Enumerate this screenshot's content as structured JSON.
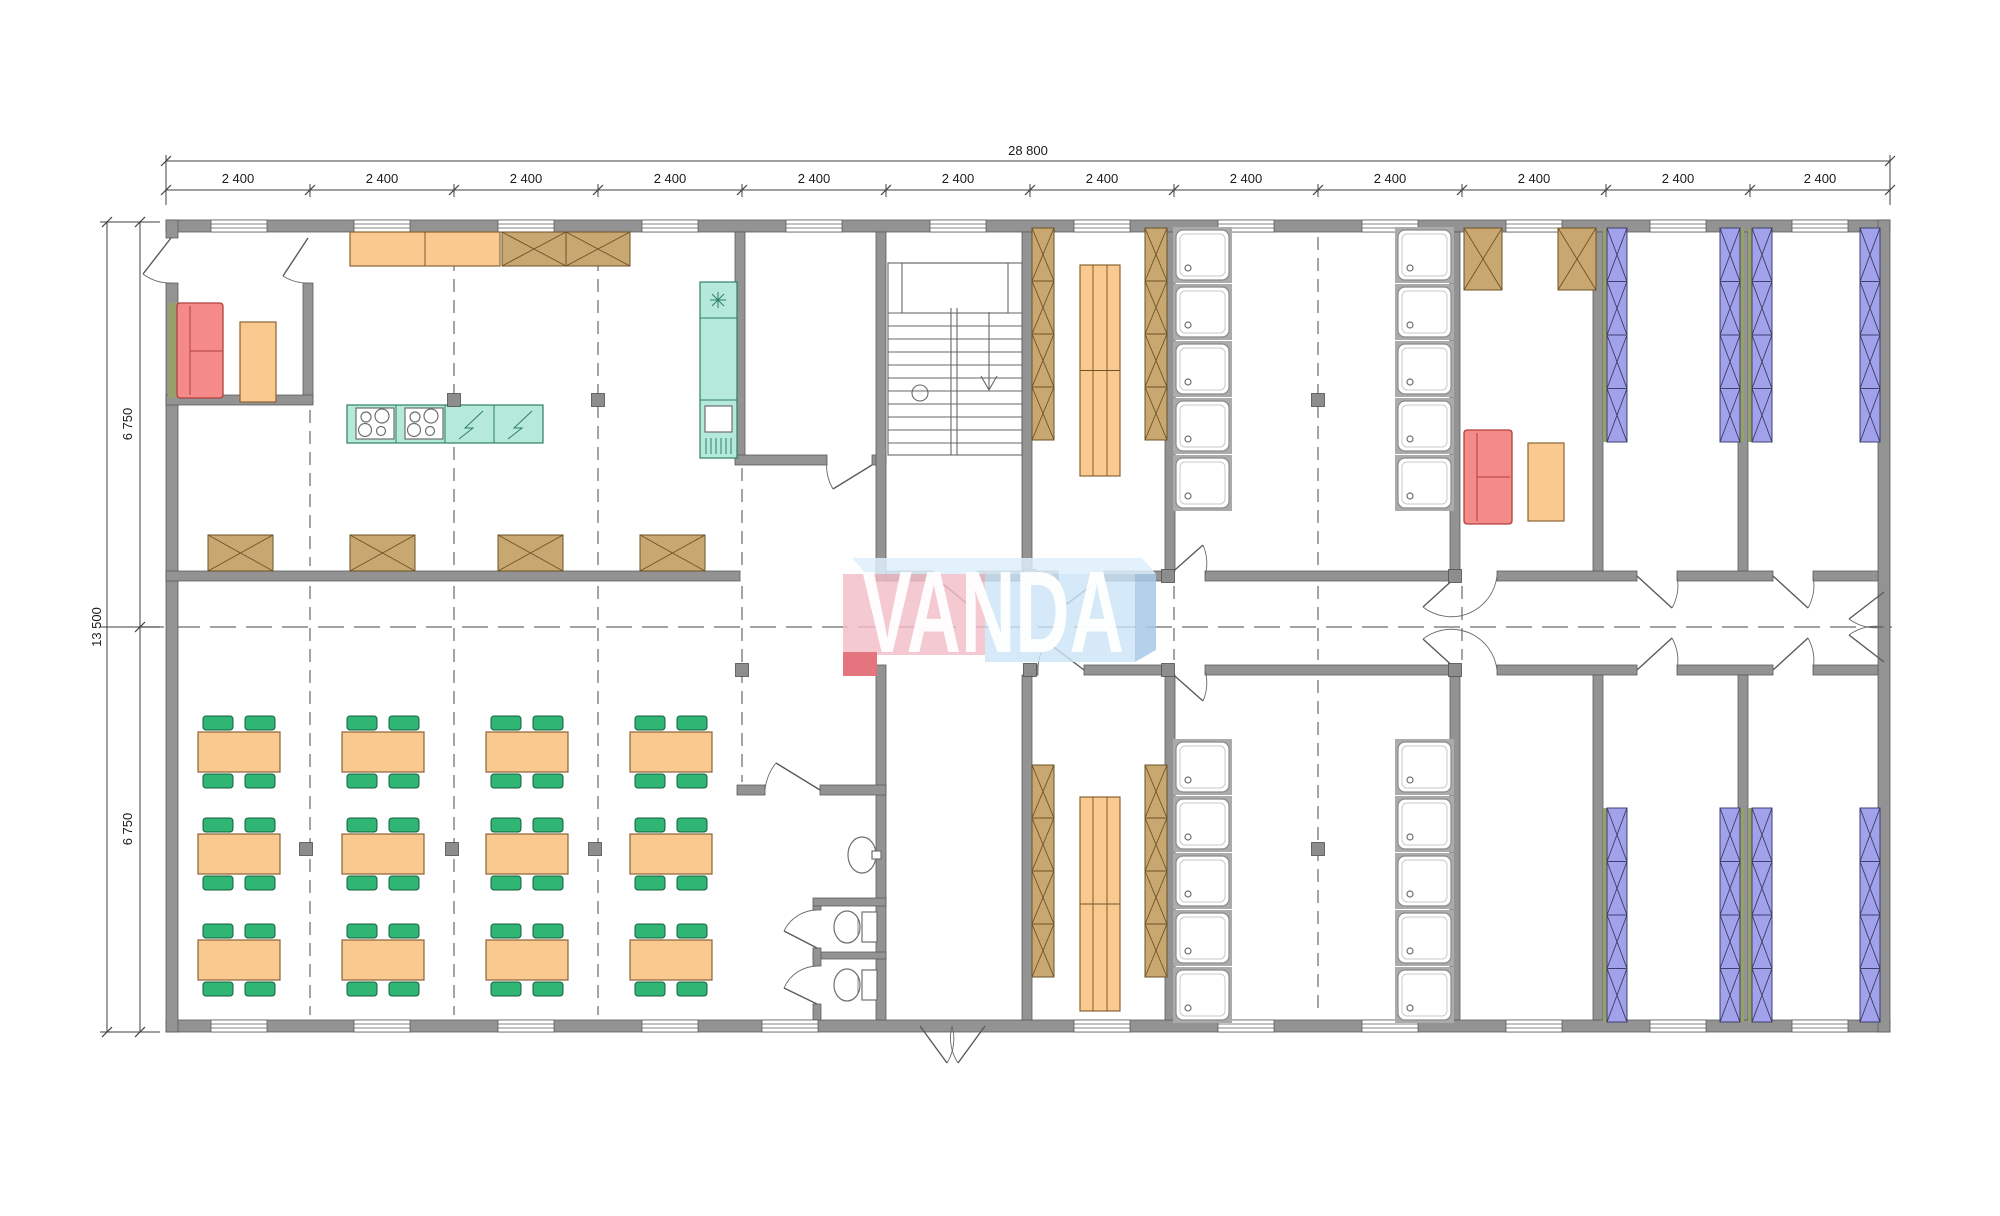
{
  "title": "VANDA modular building floor plan",
  "watermark": {
    "text": "VANDA",
    "pink": "#f3bdc8",
    "blue": "#cbe4f6"
  },
  "dimensions": {
    "top_total": "28 800",
    "top_segments": [
      "2 400",
      "2 400",
      "2 400",
      "2 400",
      "2 400",
      "2 400",
      "2 400",
      "2 400",
      "2 400",
      "2 400",
      "2 400",
      "2 400"
    ],
    "left_total": "13 500",
    "left_segments": [
      "6 750",
      "6 750"
    ]
  },
  "legend_colors": {
    "wall": "#939393",
    "table": "#fac98f",
    "chair": "#2fb574",
    "sofa": "#f58a8a",
    "bed": "#a2a2ec",
    "cabinet": "#c8a770",
    "kitchen": "#b5e9da"
  }
}
